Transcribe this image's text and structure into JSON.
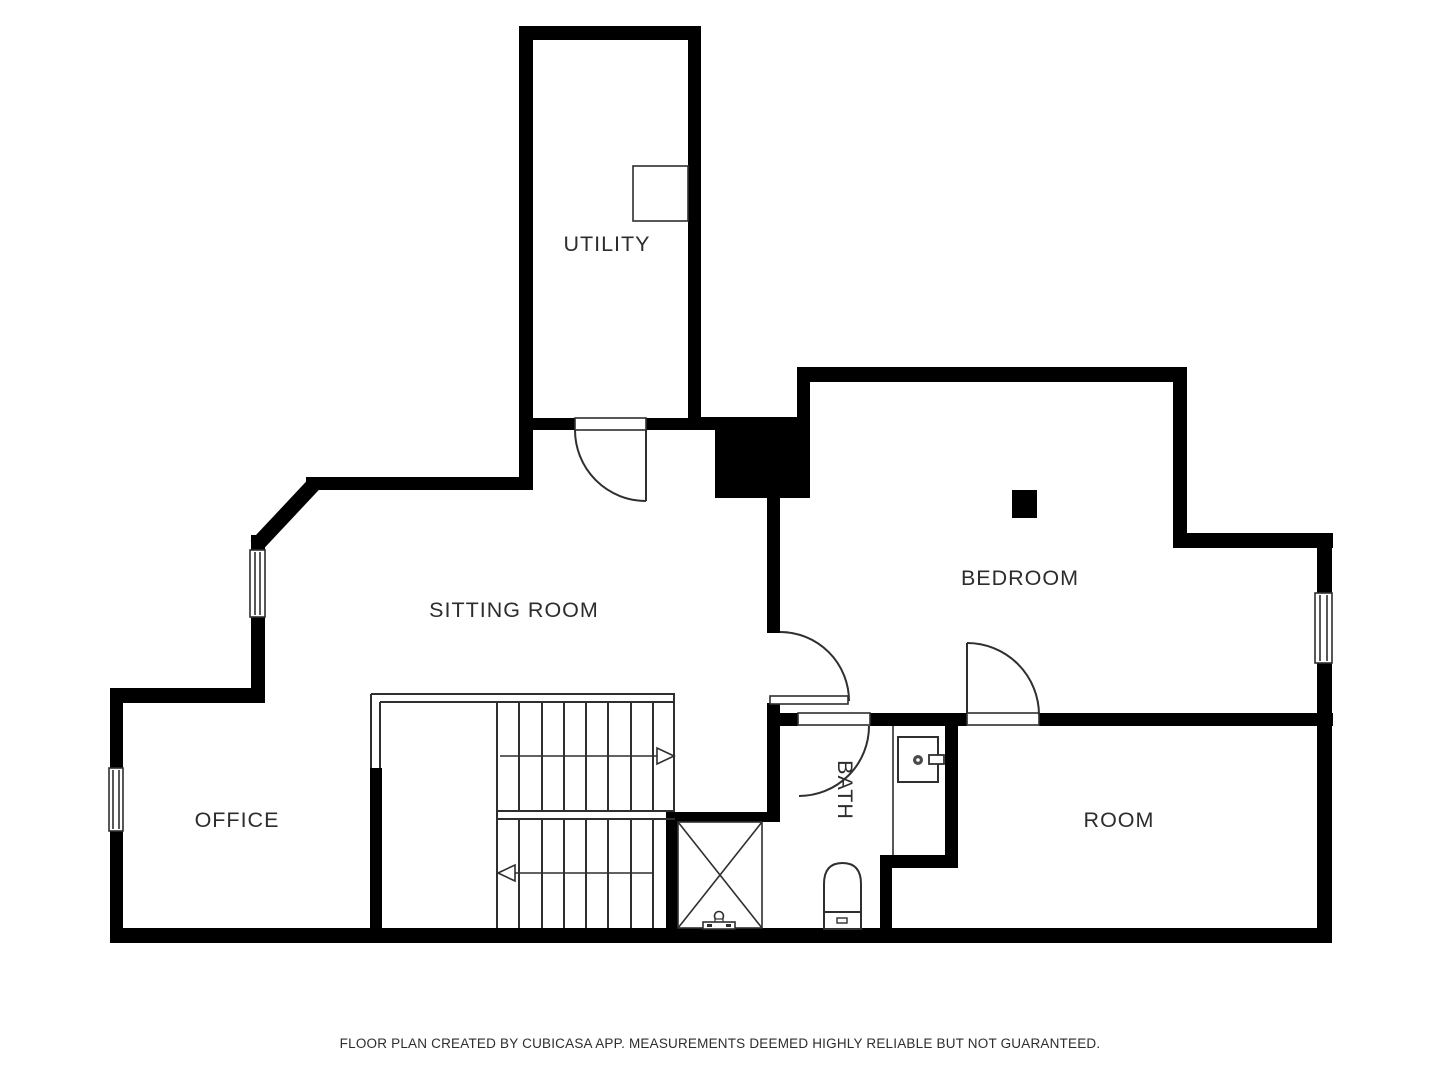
{
  "floorplan": {
    "rooms": [
      {
        "id": "utility",
        "label": "UTILITY"
      },
      {
        "id": "sitting-room",
        "label": "SITTING ROOM"
      },
      {
        "id": "bedroom",
        "label": "BEDROOM"
      },
      {
        "id": "office",
        "label": "OFFICE"
      },
      {
        "id": "bath",
        "label": "BATH"
      },
      {
        "id": "room",
        "label": "ROOM"
      }
    ],
    "fixtures": [
      {
        "id": "sink",
        "icon": "sink-icon",
        "location": "bath"
      },
      {
        "id": "toilet",
        "icon": "toilet-icon",
        "location": "bath"
      },
      {
        "id": "appliance",
        "icon": "appliance-icon",
        "location": "utility"
      },
      {
        "id": "tap",
        "icon": "tap-icon",
        "location": "stair-shaft"
      },
      {
        "id": "chimney",
        "icon": "chimney-icon",
        "location": "bedroom"
      }
    ],
    "stairs": {
      "up_arrow": "right",
      "down_arrow": "left"
    },
    "counts": {
      "doors": 4,
      "windows": 3
    },
    "footer": "FLOOR PLAN CREATED BY CUBICASA APP. MEASUREMENTS DEEMED HIGHLY RELIABLE BUT NOT GUARANTEED.",
    "colors": {
      "wall": "#000000",
      "line": "#2f2f2f",
      "text": "#2d2d2d",
      "background": "#ffffff"
    }
  }
}
